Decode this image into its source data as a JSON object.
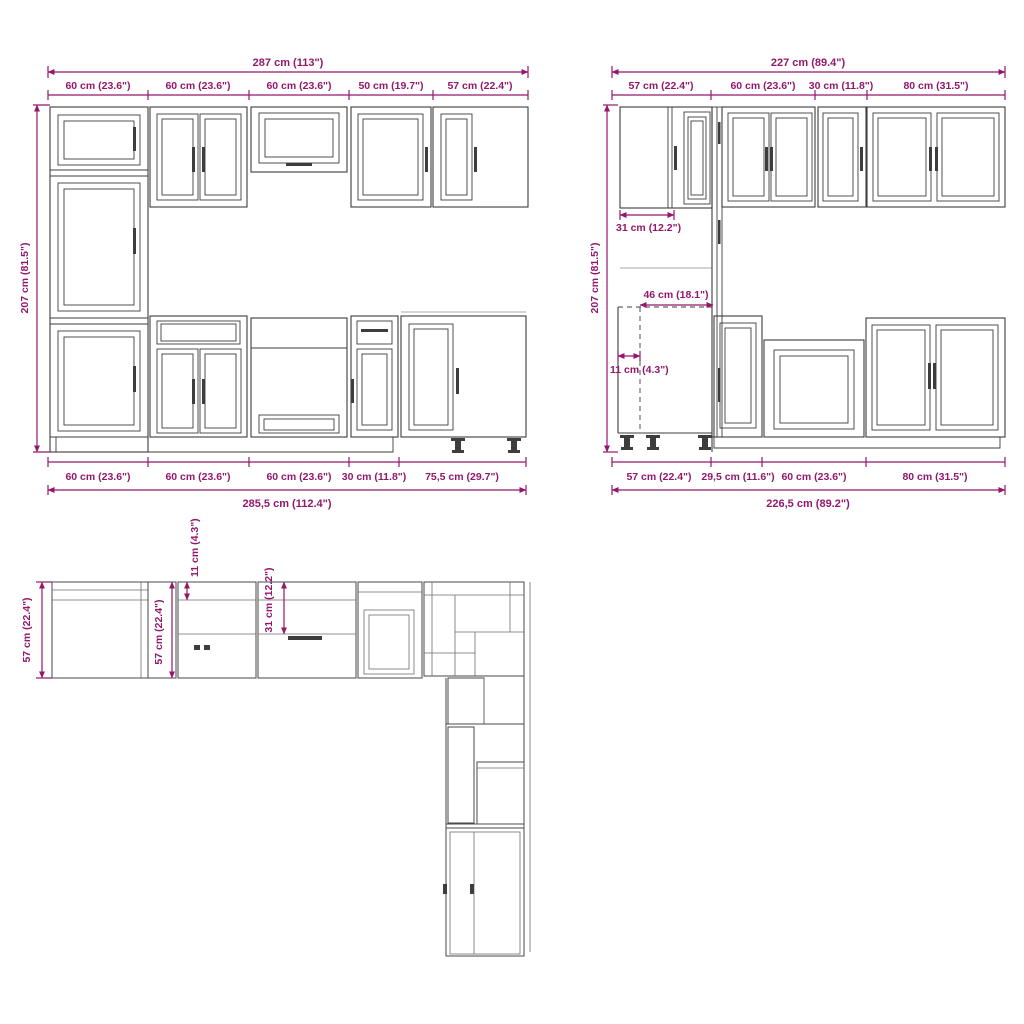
{
  "colors": {
    "dimension": "#93186C",
    "outline": "#3D3D3D"
  },
  "front_view": {
    "total_width_top": "287 cm (113\")",
    "segments_top": [
      "60 cm (23.6\")",
      "60 cm (23.6\")",
      "60 cm (23.6\")",
      "50 cm (19.7\")",
      "57 cm (22.4\")"
    ],
    "height": "207 cm (81.5\")",
    "segments_bottom": [
      "60 cm (23.6\")",
      "60 cm (23.6\")",
      "60 cm (23.6\")",
      "30 cm (11.8\")",
      "75,5 cm (29.7\")"
    ],
    "total_width_bottom": "285,5 cm (112.4\")"
  },
  "side_view": {
    "total_width_top": "227 cm (89.4\")",
    "segments_top": [
      "57 cm (22.4\")",
      "60 cm (23.6\")",
      "30 cm (11.8\")",
      "80 cm (31.5\")"
    ],
    "height": "207 cm (81.5\")",
    "corner_depth": "31 cm (12.2\")",
    "corner_clearance": "46 cm (18.1\")",
    "filler_width": "11 cm (4.3\")",
    "segments_bottom": [
      "57 cm (22.4\")",
      "29,5 cm (11.6\")",
      "60 cm (23.6\")",
      "80 cm (31.5\")"
    ],
    "total_width_bottom": "226,5 cm (89.2\")"
  },
  "plan_view": {
    "depth_left": "57 cm (22.4\")",
    "depth_inner": "57 cm (22.4\")",
    "filler_depth": "11 cm (4.3\")",
    "wall_cabinet_depth": "31 cm (12.2\")"
  }
}
